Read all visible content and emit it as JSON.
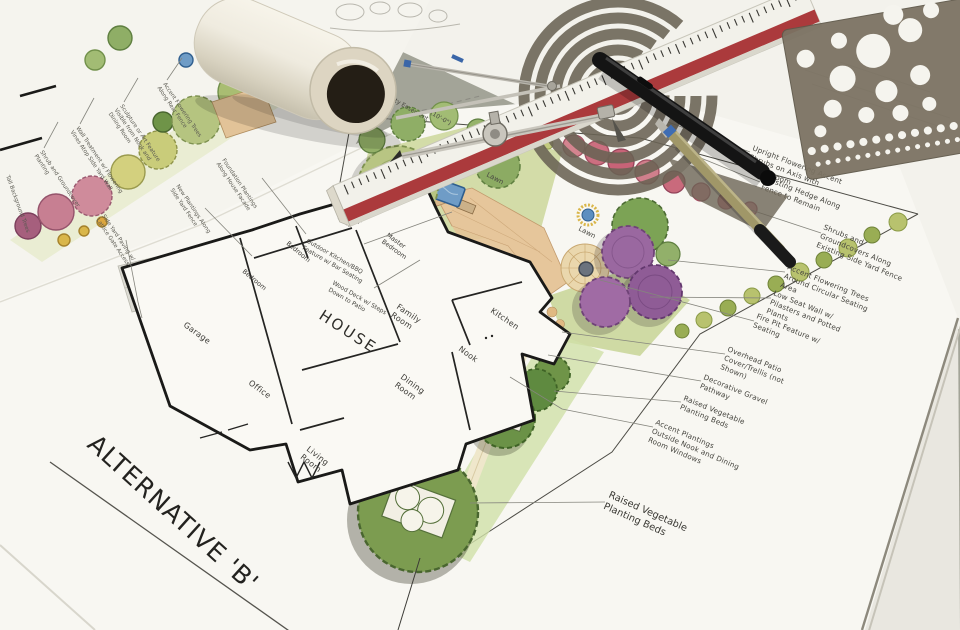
{
  "sheet": {
    "title": "ALTERNATIVE 'B'"
  },
  "plan": {
    "house": "HOUSE",
    "rooms": [
      {
        "t": "Garage"
      },
      {
        "t": "Office"
      },
      {
        "t": "Living",
        "t2": "Room"
      },
      {
        "t": "Dining",
        "t2": "Room"
      },
      {
        "t": "Nook"
      },
      {
        "t": "Kitchen"
      },
      {
        "t": "Family",
        "t2": "Room"
      },
      {
        "t": "Bedroom"
      },
      {
        "t": "Bedroom"
      },
      {
        "t": "Master",
        "t2": "Bedroom"
      },
      {
        "t": "Master",
        "t2": "Bath"
      }
    ],
    "features": [
      {
        "t": "Wood Deck w/ Steps",
        "t2": "Down to Patio"
      },
      {
        "t": "Outdoor Kitchen/BBQ",
        "t2": "Feature w/ Bar Seating"
      },
      {
        "t": "Lawn"
      },
      {
        "t": "Lawn"
      }
    ],
    "side_notes": [
      {
        "lines": [
          "Utility Easement"
        ]
      },
      {
        "lines": [
          "(10'-0\")"
        ]
      }
    ],
    "annotations": [
      {
        "lines": [
          "Upright Flowering Accent",
          "Shrubs on Axis with",
          "Family Room"
        ]
      },
      {
        "lines": [
          "Existing Hedge Along",
          "Fence to Remain"
        ]
      },
      {
        "lines": [
          "Shrubs and",
          "Groundcovers Along",
          "Existing Side Yard Fence"
        ]
      },
      {
        "lines": [
          "Accent Flowering Trees",
          "Around Circular Seating",
          "Area"
        ]
      },
      {
        "lines": [
          "Low Seat Wall w/",
          "Pilasters and Potted",
          "Plants"
        ]
      },
      {
        "lines": [
          "Fire Pit Feature w/",
          "Seating"
        ]
      },
      {
        "lines": [
          "Overhead Patio",
          "Cover/Trellis (not",
          "Shown)"
        ]
      },
      {
        "lines": [
          "Decorative Gravel",
          "Pathway"
        ]
      },
      {
        "lines": [
          "Raised Vegetable",
          "Planting Beds"
        ]
      },
      {
        "lines": [
          "Accent Plantings",
          "Outside Nook and Dining",
          "Room Windows"
        ]
      },
      {
        "lines": [
          "Raised Vegetable",
          "Planting Beds"
        ]
      }
    ]
  },
  "alt_plan": {
    "labels": [
      {
        "lines": [
          "Shrub and Groundcover",
          "Planting"
        ]
      },
      {
        "lines": [
          "Wall Treatment w/ Flowering",
          "Vines Atop Side Yard Wall"
        ]
      },
      {
        "lines": [
          "Sculpture or Art Feature",
          "Visible from Nook and",
          "Dining Room"
        ]
      },
      {
        "lines": [
          "Accent Flowering Trees",
          "Along Rear Fence"
        ]
      },
      {
        "lines": [
          "New Plantings Along",
          "Side Yard Fence"
        ]
      },
      {
        "lines": [
          "Foundation Plantings",
          "Along House Facade"
        ]
      },
      {
        "lines": [
          "Side Yard Paving w/",
          "Lattice Gate Access"
        ]
      },
      {
        "lines": [
          "Tall Background Trees"
        ]
      }
    ]
  },
  "tools": {
    "items": [
      "paper-roll",
      "spiral-arc-template",
      "triangular-scale-ruler",
      "drafting-divider",
      "drafting-compass",
      "black-marker-pen",
      "technical-pen",
      "circle-template"
    ]
  },
  "palette": {
    "paper": "#f8f7f2",
    "desk": "#a6a79b",
    "ruler_red": "#ab3a3c",
    "template_brown": "#7b7262",
    "plan_green": "#8fae66",
    "lawn_green": "#ccd79b",
    "flower_pink": "#c9677b",
    "accent_purple": "#9a68a0",
    "patio_tan": "#e6c69b",
    "water_blue": "#6f9cc6",
    "ink": "#3c3b36"
  }
}
